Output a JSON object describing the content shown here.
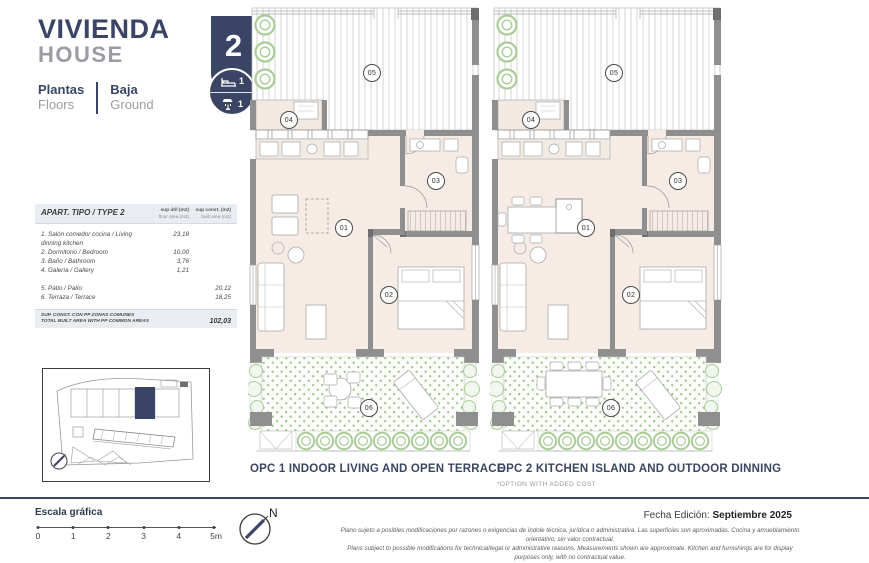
{
  "header": {
    "title": "VIVIENDA",
    "subtitle": "HOUSE",
    "unit_number": "2",
    "bedrooms_count": "1",
    "bathrooms_count": "1",
    "floors_label_es": "Plantas",
    "floors_label_en": "Floors",
    "floor_name_es": "Baja",
    "floor_name_en": "Ground"
  },
  "area_table": {
    "title": "APART. TIPO / TYPE 2",
    "col_floor_line1": "sup útil (m2)",
    "col_floor_line2": "floor area (m2)",
    "col_built_line1": "sup const. (m2)",
    "col_built_line2": "built area (m2)",
    "rows": [
      {
        "label": "1. Salón comedor cocina / Living dinning kitchen",
        "floor": "23,18",
        "built": ""
      },
      {
        "label": "2. Dormitorio / Bedroom",
        "floor": "10,00",
        "built": ""
      },
      {
        "label": "3. Baño / Bathroom",
        "floor": "3,76",
        "built": ""
      },
      {
        "label": "4. Galería / Gallery",
        "floor": "1,21",
        "built": ""
      },
      {
        "label": "5. Patio / Patio",
        "floor": "",
        "built": "20,12"
      },
      {
        "label": "6. Terraza / Terrace",
        "floor": "",
        "built": "18,25"
      }
    ],
    "total_label_es": "SUP. CONST. CON PP ZONAS COMUNES",
    "total_label_en": "TOTAL BUILT AREA WITH PP COMMON AREAS",
    "total_value": "102,03"
  },
  "room_numbers": [
    "01",
    "02",
    "03",
    "04",
    "05",
    "06"
  ],
  "plans": [
    {
      "caption": "OPC 1 INDOOR LIVING AND OPEN TERRACE",
      "note": ""
    },
    {
      "caption": "OPC 2 KITCHEN ISLAND AND OUTDOOR DINNING",
      "note": "*OPTION WITH ADDED COST"
    }
  ],
  "footer": {
    "scale_label": "Escala gráfica",
    "scale_ticks": [
      "0",
      "1",
      "2",
      "3",
      "4",
      "5m"
    ],
    "compass_label": "N",
    "edition_label": "Fecha Edición:",
    "edition_value": "Septiembre 2025",
    "disclaimer_es": "Plano sujeto a posibles modificaciones por razones o exigencias de índole técnica, jurídica o administrativa. Las superficies son aproximadas. Cocina y amueblamiento orientativo, sin valor contractual.",
    "disclaimer_en": "Plans subject to possible modifications for technical/legal or administrative reasons. Measurements shown are approximate. Kitchen and furnishings are for display purposes only, with no contractual value."
  },
  "colors": {
    "navy": "#3a4565",
    "gray_text": "#9b9da2",
    "floor_beige": "#f6ece5",
    "patio_green": "#9cc48e",
    "wall_gray": "#8f8f8f"
  }
}
